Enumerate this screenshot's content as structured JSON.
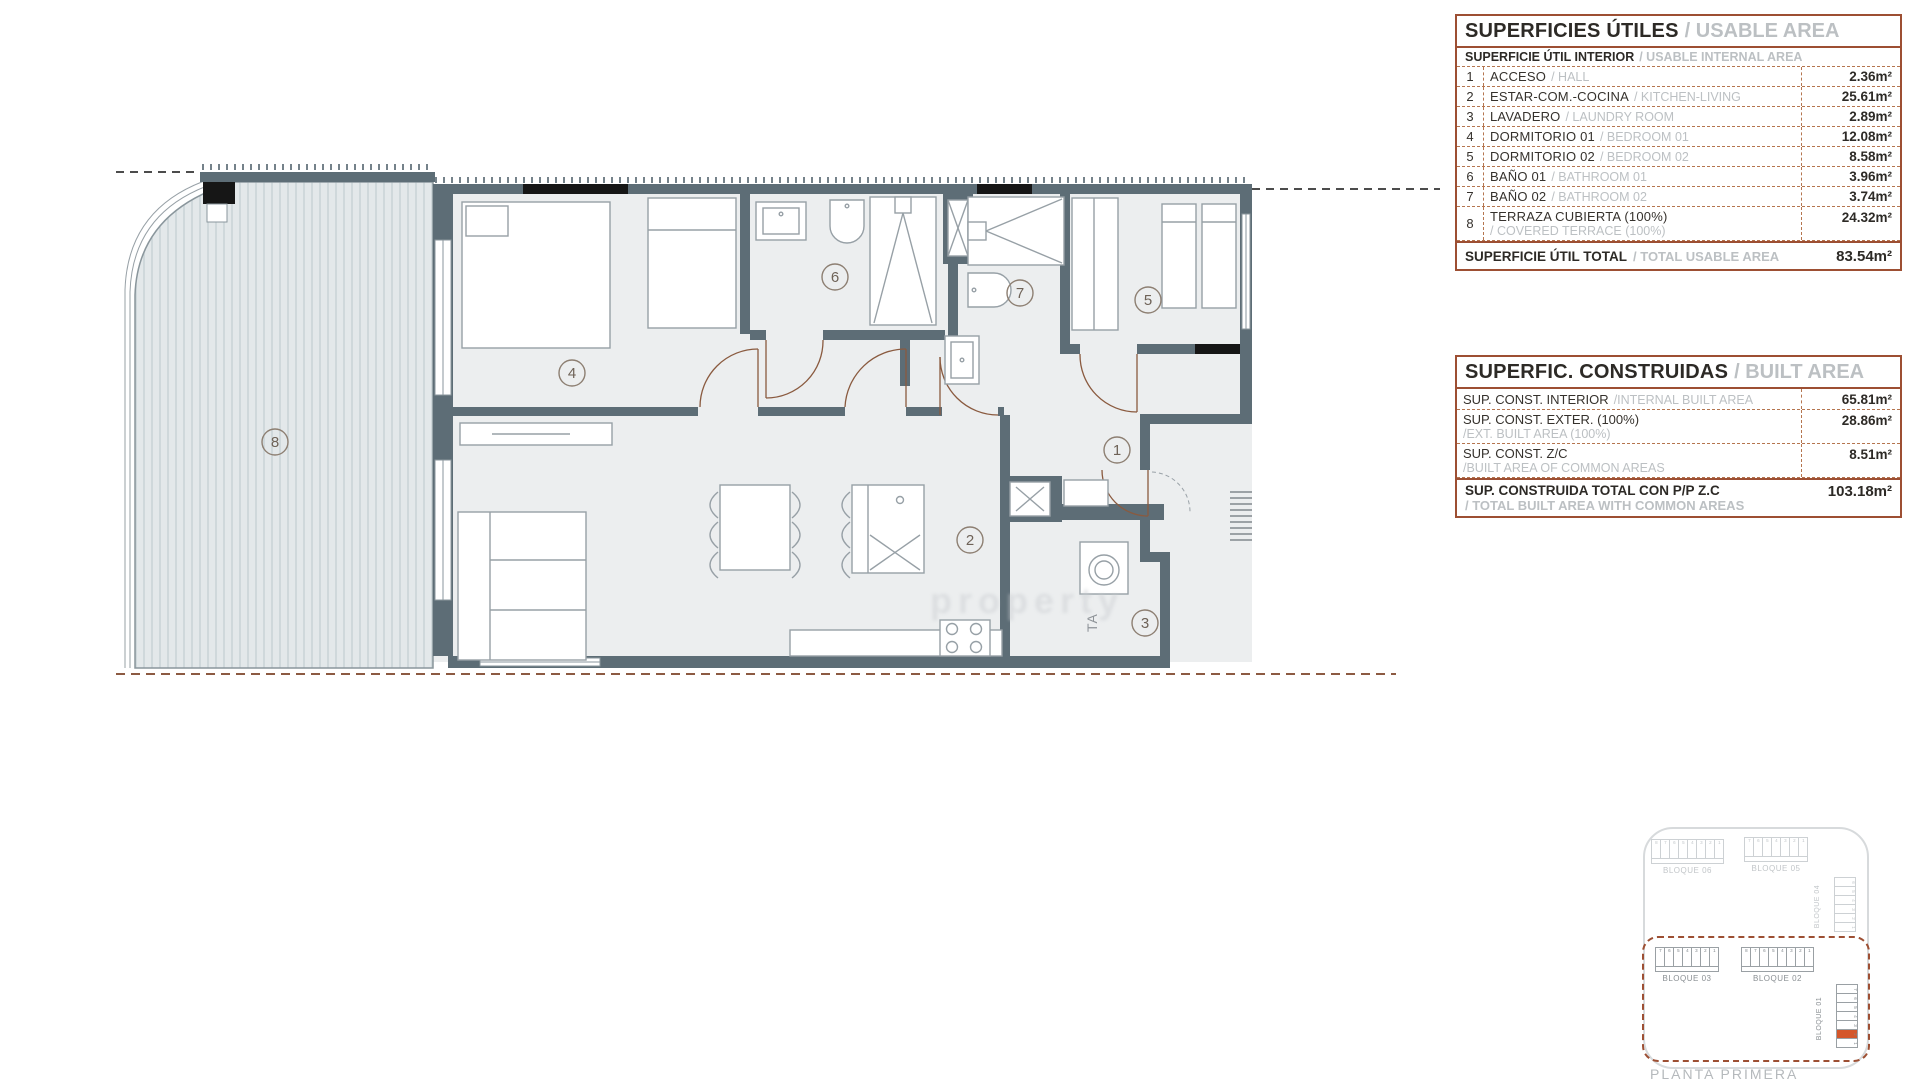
{
  "floor_plan": {
    "room_labels": [
      "1",
      "2",
      "3",
      "4",
      "5",
      "6",
      "7",
      "8"
    ],
    "ta_label": "TA",
    "watermark": "property"
  },
  "usable_area_table": {
    "title": "SUPERFICIES ÚTILES",
    "title_en": "/ USABLE AREA",
    "subtitle": "SUPERFICIE ÚTIL INTERIOR",
    "subtitle_en": "/ USABLE INTERNAL AREA",
    "rows": [
      {
        "num": "1",
        "name": "ACCESO",
        "name_en": "/ HALL",
        "value": "2.36m²"
      },
      {
        "num": "2",
        "name": "ESTAR-COM.-COCINA",
        "name_en": "/ KITCHEN-LIVING",
        "value": "25.61m²"
      },
      {
        "num": "3",
        "name": "LAVADERO",
        "name_en": "/ LAUNDRY ROOM",
        "value": "2.89m²"
      },
      {
        "num": "4",
        "name": "DORMITORIO 01",
        "name_en": "/ BEDROOM 01",
        "value": "12.08m²"
      },
      {
        "num": "5",
        "name": "DORMITORIO 02",
        "name_en": "/ BEDROOM 02",
        "value": "8.58m²"
      },
      {
        "num": "6",
        "name": "BAÑO 01",
        "name_en": "/ BATHROOM 01",
        "value": "3.96m²"
      },
      {
        "num": "7",
        "name": "BAÑO 02",
        "name_en": "/ BATHROOM 02",
        "value": "3.74m²"
      },
      {
        "num": "8",
        "name": "TERRAZA CUBIERTA (100%)",
        "name_en": "/ COVERED TERRACE (100%)",
        "value": "24.32m²"
      }
    ],
    "total_label": "SUPERFICIE ÚTIL TOTAL",
    "total_label_en": "/ TOTAL USABLE AREA",
    "total_value": "83.54m²"
  },
  "built_area_table": {
    "title": "SUPERFIC. CONSTRUIDAS",
    "title_en": "/ BUILT AREA",
    "rows": [
      {
        "name": "SUP. CONST. INTERIOR",
        "name_en": "/INTERNAL BUILT AREA",
        "value": "65.81m²"
      },
      {
        "name": "SUP. CONST. EXTER. (100%)",
        "name_en": "/EXT. BUILT AREA (100%)",
        "value": "28.86m²"
      },
      {
        "name": "SUP. CONST. Z/C",
        "name_en": "/BUILT AREA OF COMMON AREAS",
        "value": "8.51m²"
      }
    ],
    "total_label": "SUP. CONSTRUIDA TOTAL CON P/P Z.C",
    "total_label_en": "/ TOTAL BUILT AREA WITH COMMON AREAS",
    "total_value": "103.18m²"
  },
  "site_plan": {
    "caption": "PLANTA PRIMERA",
    "blocks": [
      {
        "name": "BLOQUE 06",
        "units": [
          "8",
          "7",
          "6",
          "5",
          "4",
          "3",
          "2",
          "1"
        ]
      },
      {
        "name": "BLOQUE 05",
        "units": [
          "7",
          "6",
          "5",
          "4",
          "3",
          "2",
          "1"
        ]
      },
      {
        "name": "BLOQUE 04",
        "units": [
          "6",
          "5",
          "4",
          "3",
          "2",
          "1"
        ]
      },
      {
        "name": "BLOQUE 03",
        "units": [
          "7",
          "6",
          "5",
          "4",
          "3",
          "2",
          "1"
        ]
      },
      {
        "name": "BLOQUE 02",
        "units": [
          "8",
          "7",
          "6",
          "5",
          "4",
          "3",
          "2",
          "1"
        ]
      },
      {
        "name": "BLOQUE 01",
        "units": [
          "7",
          "6",
          "5",
          "4",
          "3",
          "2",
          "1"
        ],
        "highlighted": "2"
      }
    ]
  }
}
